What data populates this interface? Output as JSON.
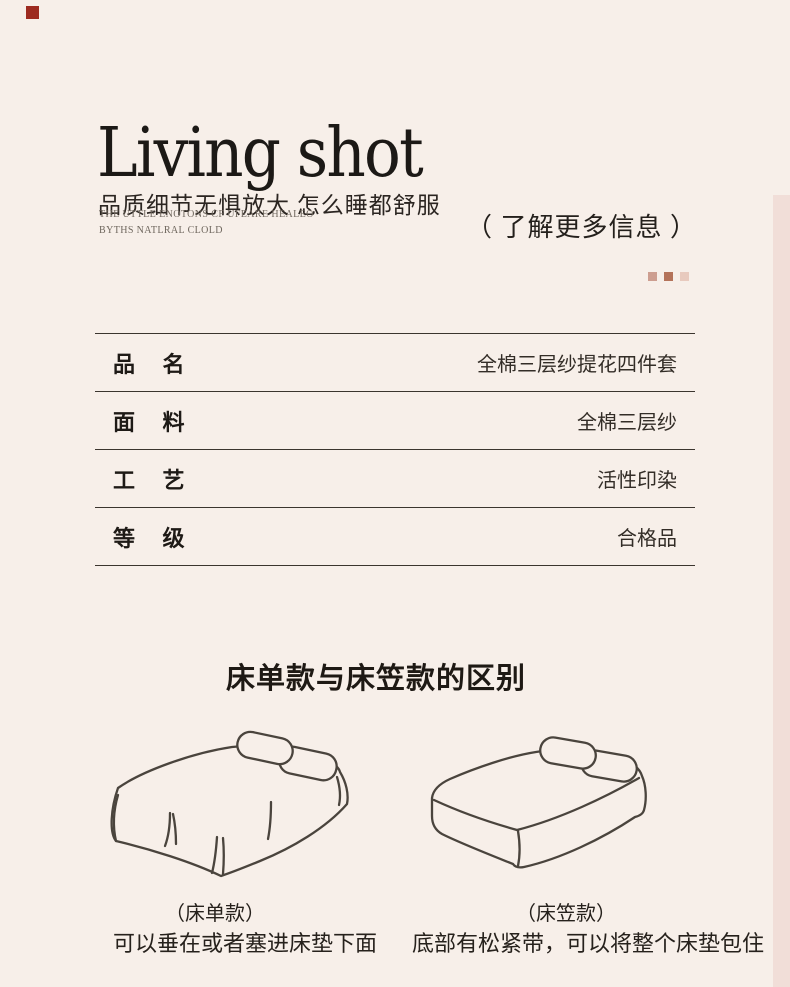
{
  "page": {
    "background": "#f7efe9",
    "accent_square_style": "background:#9d2b20",
    "edge_strip_style": "background:#f1ded8"
  },
  "header": {
    "title": "Living shot",
    "subtitle": "品质细节无惧放大 怎么睡都舒服",
    "tagline_line1": "THE UTTLE ENOTONS CF UFEARE HEALEO",
    "tagline_line2": "BYTHS NATLRAL CLOLD",
    "more_info": "（ 了解更多信息 ）",
    "dots": [
      {
        "name": "dot-1",
        "color": "#cd9e90",
        "style": "background:#cd9e90"
      },
      {
        "name": "dot-2",
        "color": "#b4735a",
        "style": "background:#b4735a"
      },
      {
        "name": "dot-3",
        "color": "#e8cabe",
        "style": "background:#e8cabe"
      }
    ]
  },
  "specs": {
    "rows": [
      {
        "label": "品 名",
        "value": "全棉三层纱提花四件套"
      },
      {
        "label": "面 料",
        "value": "全棉三层纱"
      },
      {
        "label": "工 艺",
        "value": "活性印染"
      },
      {
        "label": "等 级",
        "value": "合格品"
      }
    ]
  },
  "comparison": {
    "heading": "床单款与床笠款的区别",
    "items": [
      {
        "name": "（床单款）",
        "description": "可以垂在或者塞进床垫下面",
        "illustration": "flat-sheet-bed"
      },
      {
        "name": "（床笠款）",
        "description": "底部有松紧带，可以将整个床垫包住",
        "illustration": "fitted-sheet-bed"
      }
    ]
  }
}
